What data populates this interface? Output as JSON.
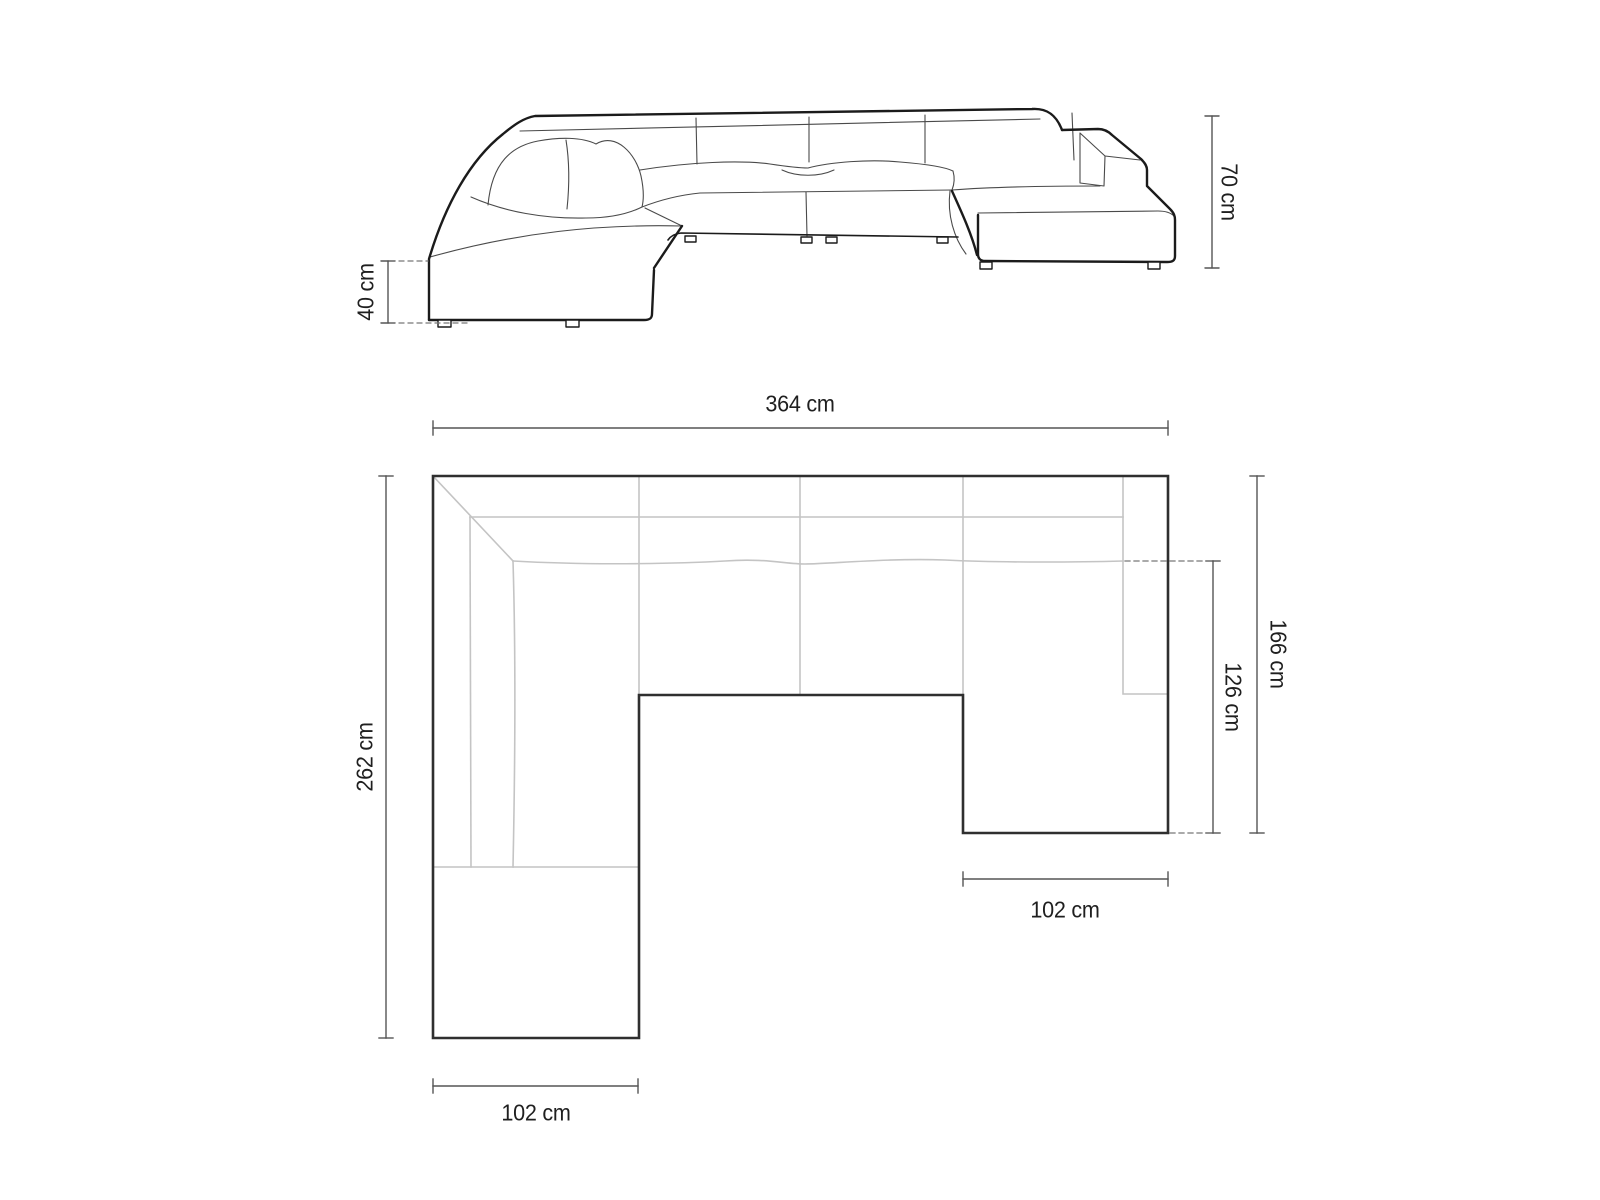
{
  "labels": {
    "side_height": "70 cm",
    "side_seat_height": "40 cm",
    "plan_width": "364 cm",
    "plan_left_depth": "262 cm",
    "plan_right_depth": "166 cm",
    "plan_right_inner_depth": "126 cm",
    "plan_right_chaise_width": "102 cm",
    "plan_left_chaise_width": "102 cm"
  },
  "colors": {
    "background": "#ffffff",
    "outline": "#1b1b1b",
    "detail": "#4a4a4a",
    "plan_outline": "#2f2f2f",
    "seam": "#c4c4c4",
    "dimension": "#555555",
    "dash": "#777777",
    "text": "#1f1f1f"
  }
}
